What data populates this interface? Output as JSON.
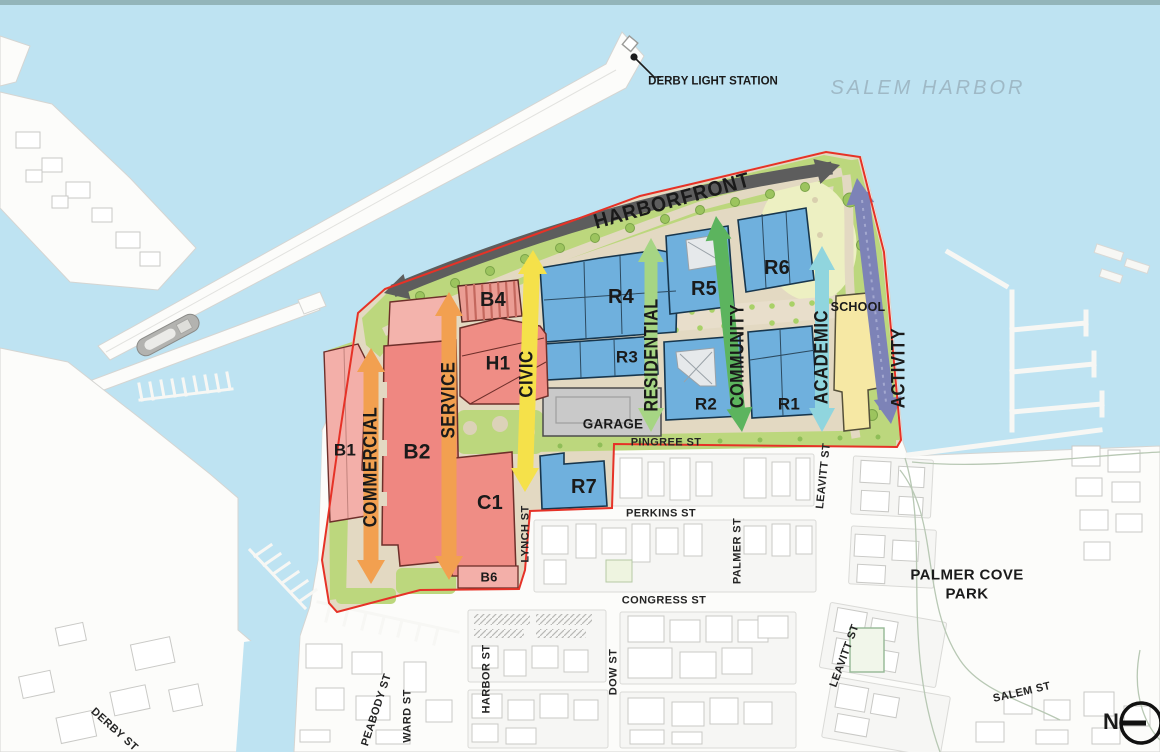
{
  "title": "Salem Harbor waterfront district plan",
  "water": {
    "harbor_label": "SALEM HARBOR"
  },
  "landmarks": {
    "light_station": "DERBY LIGHT STATION",
    "park_line1": "PALMER COVE",
    "park_line2": "PARK"
  },
  "corridors": {
    "harborfront": "HARBORFRONT",
    "commercial": "COMMERCIAL",
    "service": "SERVICE",
    "civic": "CIVIC",
    "residential": "RESIDENTIAL",
    "community": "COMMUNITY",
    "academic": "ACADEMIC",
    "activity": "ACTIVITY"
  },
  "buildings": {
    "b1": "B1",
    "b2": "B2",
    "b4": "B4",
    "b6": "B6",
    "h1": "H1",
    "c1": "C1",
    "r1": "R1",
    "r2": "R2",
    "r3": "R3",
    "r4": "R4",
    "r5": "R5",
    "r6": "R6",
    "r7": "R7",
    "school": "SCHOOL",
    "garage": "GARAGE"
  },
  "streets": {
    "pingree": "PINGREE ST",
    "perkins": "PERKINS ST",
    "congress": "CONGRESS ST",
    "lynch": "LYNCH ST",
    "harbor": "HARBOR ST",
    "dow": "DOW ST",
    "ward": "WARD ST",
    "peabody": "PEABODY ST",
    "derby": "DERBY ST",
    "palmer": "PALMER ST",
    "leavitt": "LEAVITT ST",
    "salem": "SALEM ST"
  },
  "compass": {
    "north": "N"
  },
  "colors": {
    "water": "#bee3f2",
    "site_tan": "#e3d9c2",
    "site_green": "#bcd77d",
    "residential_blue": "#6fb0dd",
    "commercial_red": "#ef8781",
    "commercial_light_pink": "#f3afa9",
    "school_yellow": "#f6e8a4",
    "garage_gray": "#c9c9c9",
    "arrow_orange": "#f2a050",
    "arrow_yellow": "#f5e14a",
    "arrow_light_green": "#a6d584",
    "arrow_green": "#5cb45e",
    "arrow_cyan": "#90d5de",
    "arrow_purple": "#7d83b7",
    "arrow_dark": "#5d5d5d",
    "site_boundary_red": "#e63227"
  }
}
